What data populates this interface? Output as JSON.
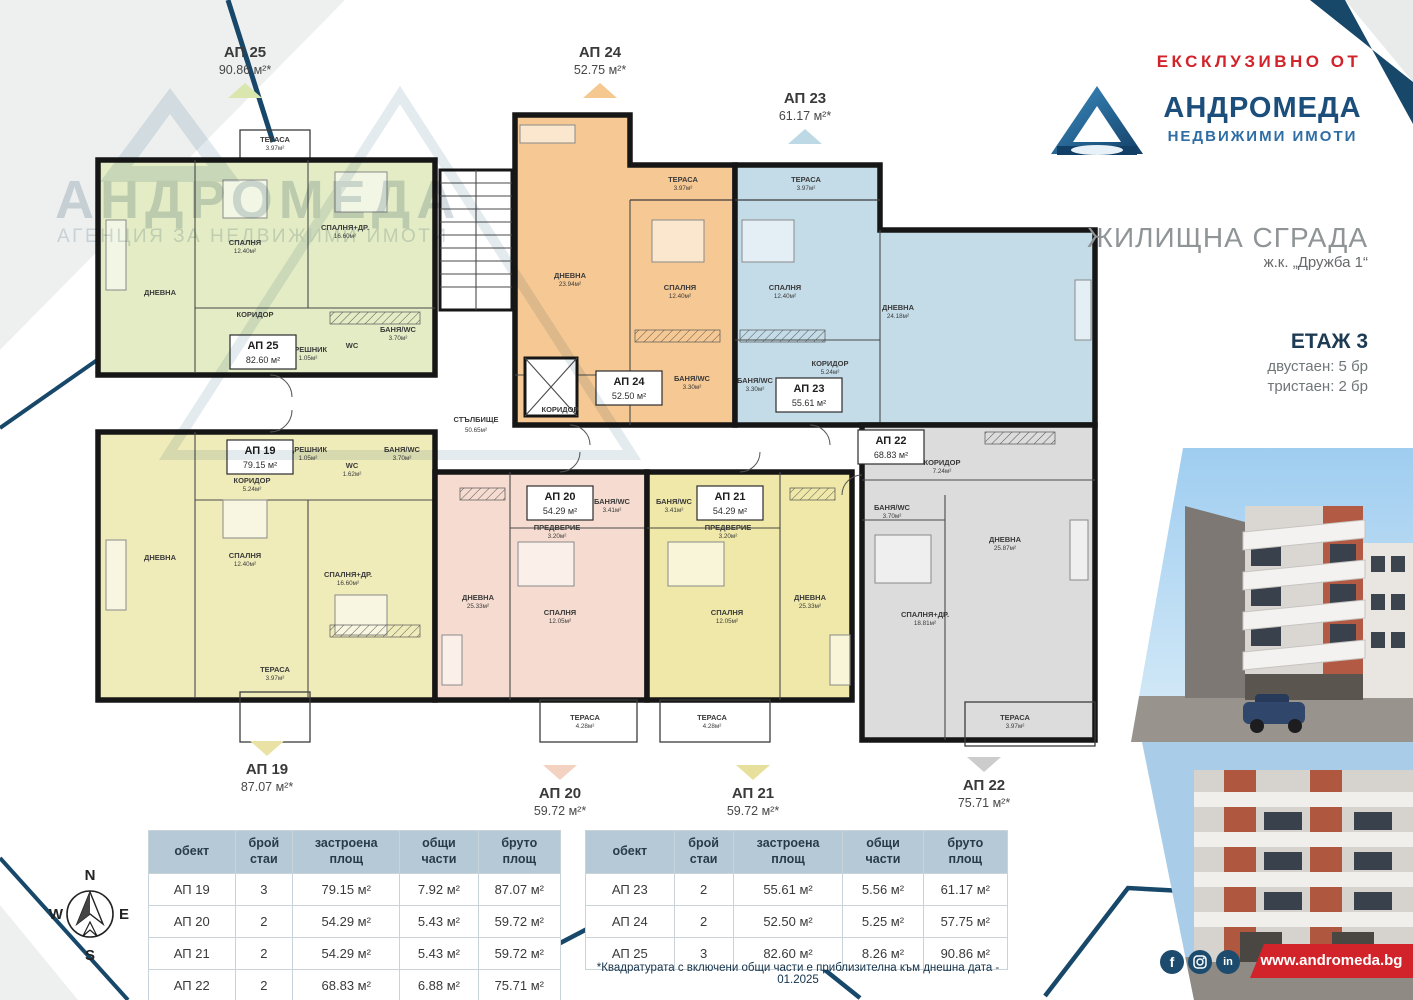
{
  "header": {
    "exclusive": "ЕКСКЛУЗИВНО ОТ",
    "brand": "АНДРОМЕДА",
    "brand_sub": "НЕДВИЖИМИ ИМОТИ",
    "title": "ЖИЛИЩНА СГРАДА",
    "location": "ж.к. „Дружба 1“",
    "floor": "ЕТАЖ 3",
    "stat1": "двустаен: 5 бр",
    "stat2": "тристаен: 2 бр"
  },
  "watermark": {
    "brand": "АНДРОМЕДА",
    "sub": "АГЕНЦИЯ ЗА НЕДВИЖИМИ ИМОТИ"
  },
  "callouts": {
    "ap25": {
      "id": "АП 25",
      "area": "90.86 м²*"
    },
    "ap24": {
      "id": "АП 24",
      "area": "52.75 м²*"
    },
    "ap23": {
      "id": "АП 23",
      "area": "61.17 м²*"
    },
    "ap19": {
      "id": "АП 19",
      "area": "87.07 м²*"
    },
    "ap20": {
      "id": "АП 20",
      "area": "59.72 м²*"
    },
    "ap21": {
      "id": "АП 21",
      "area": "59.72 м²*"
    },
    "ap22": {
      "id": "АП 22",
      "area": "75.71 м²*"
    }
  },
  "plan": {
    "stair": {
      "name": "СТЪЛБИЩЕ",
      "area": "50.65м²"
    },
    "ap25": {
      "id": "АП 25",
      "area": "82.60 м²",
      "rooms": {
        "ter": {
          "name": "ТЕРАСА",
          "area": "3.97м²"
        },
        "liv": {
          "name": "ДНЕВНА",
          "area": ""
        },
        "bed": {
          "name": "СПАЛНЯ",
          "area": "12.40м²"
        },
        "bed2": {
          "name": "СПАЛНЯ+ДР.",
          "area": "16.60м²"
        },
        "cor": {
          "name": "КОРИДОР",
          "area": ""
        },
        "dr": {
          "name": "ДРЕШНИК",
          "area": "1.05м²"
        },
        "wc": {
          "name": "WC",
          "area": ""
        },
        "bath": {
          "name": "БАНЯ/WC",
          "area": "3.70м²"
        }
      }
    },
    "ap24": {
      "id": "АП 24",
      "area": "52.50 м²",
      "rooms": {
        "ter": {
          "name": "ТЕРАСА",
          "area": "3.97м²"
        },
        "liv": {
          "name": "ДНЕВНА",
          "area": "23.94м²"
        },
        "bed": {
          "name": "СПАЛНЯ",
          "area": "12.40м²"
        },
        "cor": {
          "name": "КОРИДОР",
          "area": ""
        },
        "bath": {
          "name": "БАНЯ/WC",
          "area": "3.30м²"
        }
      }
    },
    "ap23": {
      "id": "АП 23",
      "area": "55.61 м²",
      "rooms": {
        "ter": {
          "name": "ТЕРАСА",
          "area": "3.97м²"
        },
        "bed": {
          "name": "СПАЛНЯ",
          "area": "12.40м²"
        },
        "liv": {
          "name": "ДНЕВНА",
          "area": "24.18м²"
        },
        "cor": {
          "name": "КОРИДОР",
          "area": "5.24м²"
        },
        "bath": {
          "name": "БАНЯ/WC",
          "area": "3.30м²"
        }
      }
    },
    "ap19": {
      "id": "АП 19",
      "area": "79.15 м²",
      "rooms": {
        "liv": {
          "name": "ДНЕВНА",
          "area": ""
        },
        "bed": {
          "name": "СПАЛНЯ",
          "area": "12.40м²"
        },
        "bed2": {
          "name": "СПАЛНЯ+ДР.",
          "area": "16.60м²"
        },
        "cor": {
          "name": "КОРИДОР",
          "area": "5.24м²"
        },
        "dr": {
          "name": "ДРЕШНИК",
          "area": "1.05м²"
        },
        "wc": {
          "name": "WC",
          "area": "1.62м²"
        },
        "bath": {
          "name": "БАНЯ/WC",
          "area": "3.70м²"
        },
        "ter": {
          "name": "ТЕРАСА",
          "area": "3.97м²"
        }
      }
    },
    "ap20": {
      "id": "АП 20",
      "area": "54.29 м²",
      "rooms": {
        "liv": {
          "name": "ДНЕВНА",
          "area": "25.33м²"
        },
        "bed": {
          "name": "СПАЛНЯ",
          "area": "12.05м²"
        },
        "ante": {
          "name": "ПРЕДВЕРИЕ",
          "area": "3.20м²"
        },
        "bath": {
          "name": "БАНЯ/WC",
          "area": "3.41м²"
        },
        "ter": {
          "name": "ТЕРАСА",
          "area": "4.28м²"
        }
      }
    },
    "ap21": {
      "id": "АП 21",
      "area": "54.29 м²",
      "rooms": {
        "liv": {
          "name": "ДНЕВНА",
          "area": "25.33м²"
        },
        "bed": {
          "name": "СПАЛНЯ",
          "area": "12.05м²"
        },
        "ante": {
          "name": "ПРЕДВЕРИЕ",
          "area": "3.20м²"
        },
        "bath": {
          "name": "БАНЯ/WC",
          "area": "3.41м²"
        },
        "ter": {
          "name": "ТЕРАСА",
          "area": "4.28м²"
        }
      }
    },
    "ap22": {
      "id": "АП 22",
      "area": "68.83 м²",
      "rooms": {
        "cor": {
          "name": "КОРИДОР",
          "area": "7.24м²"
        },
        "liv": {
          "name": "ДНЕВНА",
          "area": "25.87м²"
        },
        "bed2": {
          "name": "СПАЛНЯ+ДР.",
          "area": "18.81м²"
        },
        "bath": {
          "name": "БАНЯ/WC",
          "area": "3.70м²"
        },
        "ter": {
          "name": "ТЕРАСА",
          "area": "3.97м²"
        }
      }
    }
  },
  "table_left": {
    "headers": [
      "обект",
      "брой стаи",
      "застроена площ",
      "общи части",
      "бруто площ"
    ],
    "rows": [
      [
        "АП 19",
        "3",
        "79.15 м²",
        "7.92 м²",
        "87.07 м²"
      ],
      [
        "АП 20",
        "2",
        "54.29 м²",
        "5.43 м²",
        "59.72 м²"
      ],
      [
        "АП 21",
        "2",
        "54.29 м²",
        "5.43 м²",
        "59.72 м²"
      ],
      [
        "АП 22",
        "2",
        "68.83 м²",
        "6.88 м²",
        "75.71 м²"
      ]
    ]
  },
  "table_right": {
    "headers": [
      "обект",
      "брой стаи",
      "застроена площ",
      "общи части",
      "бруто площ"
    ],
    "rows": [
      [
        "АП 23",
        "2",
        "55.61 м²",
        "5.56 м²",
        "61.17 м²"
      ],
      [
        "АП 24",
        "2",
        "52.50 м²",
        "5.25 м²",
        "57.75 м²"
      ],
      [
        "АП 25",
        "3",
        "82.60 м²",
        "8.26 м²",
        "90.86 м²"
      ]
    ]
  },
  "footnote": "*Квадратурата с включени общи части е приблизителна към днешна дата - 01.2025",
  "footer": {
    "website": "www.andromeda.bg"
  },
  "icons": {
    "facebook": "f",
    "instagram": "instagram-camera",
    "linkedin": "in"
  },
  "compass": {
    "n": "N",
    "e": "E",
    "s": "S",
    "w": "W"
  },
  "colors": {
    "navy": "#17486a",
    "red": "#d2232a",
    "ap25": "#e3ecc5",
    "ap24": "#f6c893",
    "ap23": "#c3dce8",
    "ap19": "#f0ecba",
    "ap20": "#f6dcd0",
    "ap21": "#efe8a8",
    "ap22": "#dcdcdc"
  }
}
